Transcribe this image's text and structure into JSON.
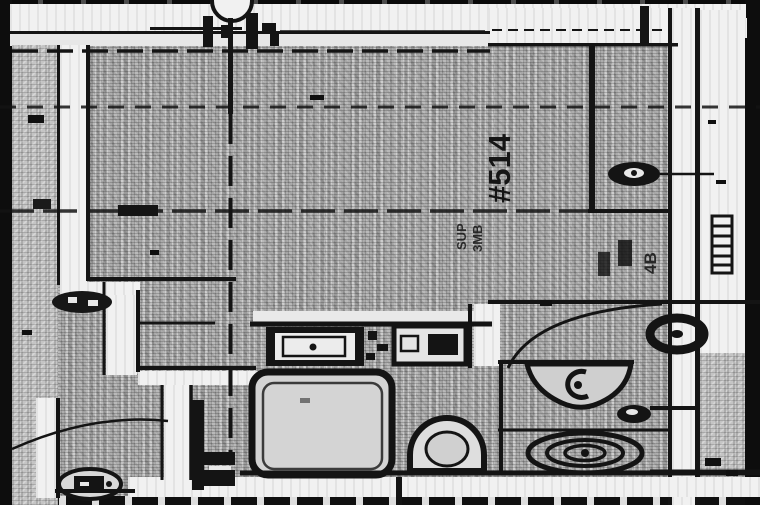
{
  "document": {
    "kind_label": "scanned architectural floor plan",
    "room_number": "#514",
    "room_sublabel_line1": "SUP",
    "room_sublabel_line2": "3MB",
    "shaft_label": "4B"
  },
  "colors": {
    "paper_halftone_gray": "#b9b9b9",
    "wall_white": "#f1f1f1",
    "ink_black": "#141414",
    "scan_margin_black": "#0d0d0d"
  },
  "fixtures": [
    "grid-bubble",
    "column-grid-line",
    "bathtub",
    "vanity-sink",
    "second-sink",
    "wash-basin",
    "toilet",
    "floor-drain-rings",
    "ceiling-fixture-donut",
    "exhaust-fan-upper",
    "exhaust-fan-lower",
    "door-swing-arc-bathroom",
    "door-swing-arc-entry",
    "wall-hatch-bar",
    "door-jamb-symbols"
  ]
}
